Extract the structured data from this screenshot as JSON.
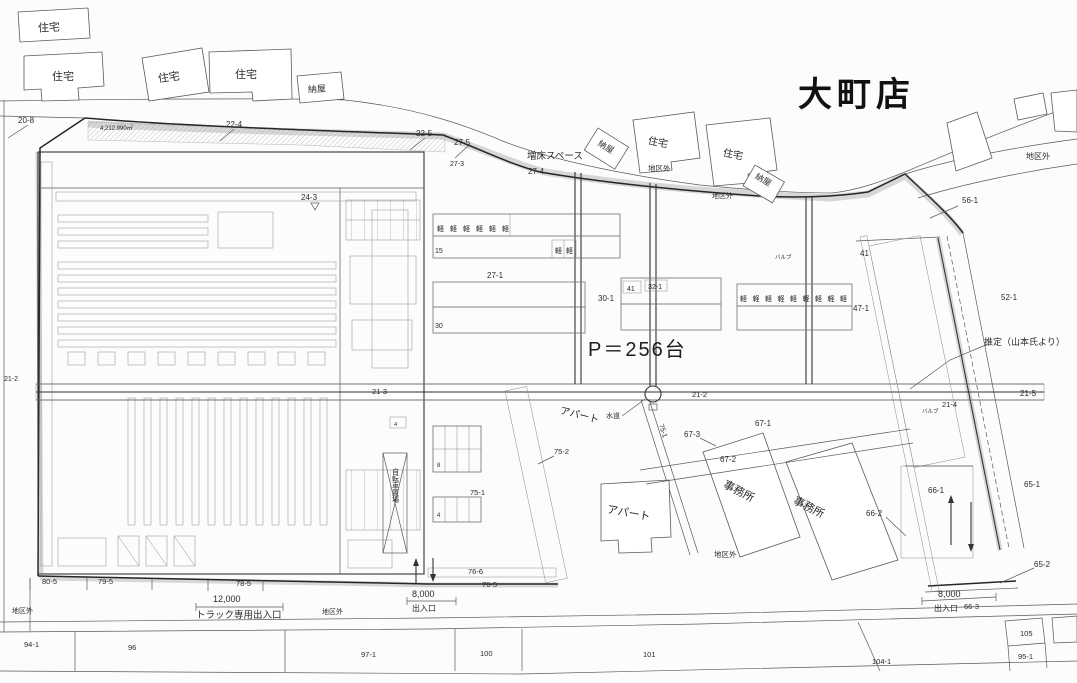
{
  "title": "大町店",
  "buildings": {
    "house": "住宅",
    "barn": "納屋",
    "office": "事務所",
    "apartment": "アパート"
  },
  "annotations": {
    "district_outside": "地区外",
    "expansion_space": "増床スペース",
    "parking_capacity": "P＝256台",
    "estimate_note": "推定（山本氏より）",
    "water_supply": "水道",
    "truck_gate_label": "トラック専用出入口",
    "gate_label": "出入口",
    "truck_gate_width": "12,000",
    "gate_width": "8,000",
    "site_area": "4,212.990㎡",
    "bicycle_parking": "自転車置場",
    "valve": "バルブ",
    "kei_row_6": "軽軽軽軽軽軽",
    "kei_row_2": "軽軽",
    "kei_row_9": "軽軽軽軽軽軽軽軽軽",
    "count_15": "15",
    "count_30": "30",
    "count_8": "8",
    "count_4": "4"
  },
  "parcels": {
    "p20_8": "20-8",
    "p22_4": "22-4",
    "p22_5": "22-5",
    "p24_3": "24-3",
    "p27_5": "27-5",
    "p27_3": "27-3",
    "p27_4": "27-4",
    "p27_1": "27-1",
    "p30_1": "30-1",
    "p32_1": "32-1",
    "p41": "41",
    "p47_1": "47-1",
    "p52_1": "52-1",
    "p56_1": "56-1",
    "p21_2": "21-2",
    "p21_3": "21-3",
    "p21_4": "21-4",
    "p21_5": "21-5",
    "p65_1": "65-1",
    "p65_2": "65-2",
    "p66_1": "66-1",
    "p66_2": "66-2",
    "p66_3": "66-3",
    "p67_1": "67-1",
    "p67_2": "67-2",
    "p67_3": "67-3",
    "p75_1": "75-1",
    "p75_2": "75-2",
    "p76_5": "76-5",
    "p76_6": "76-6",
    "p78_5": "78-5",
    "p79_5": "79-5",
    "p80_5": "80-5",
    "p94_1": "94-1",
    "p95_1": "95-1",
    "p96": "96",
    "p97_1": "97-1",
    "p100": "100",
    "p101": "101",
    "p104_1": "104-1",
    "p105": "105"
  }
}
